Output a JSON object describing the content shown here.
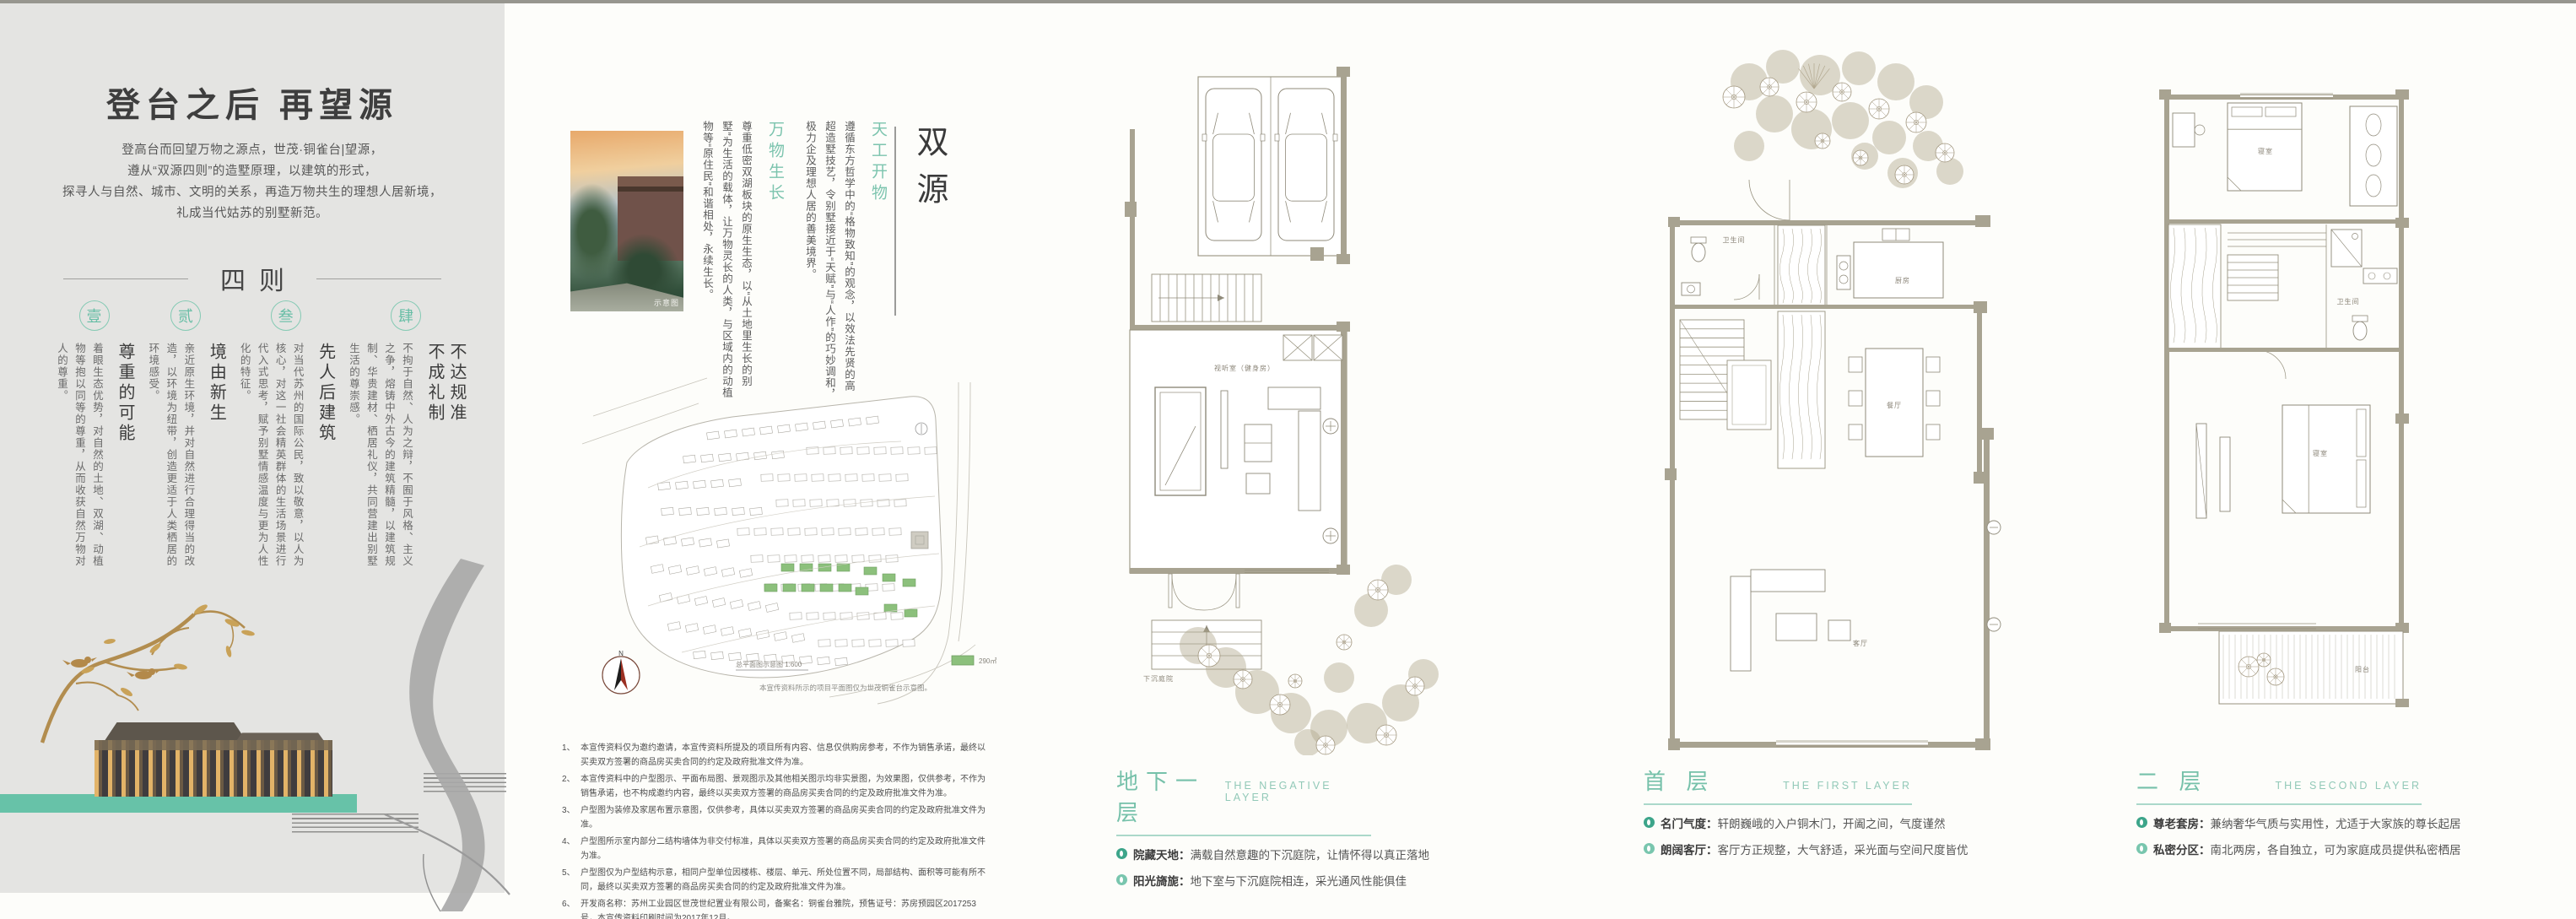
{
  "colors": {
    "accent_teal": "#74c3ab",
    "band_teal": "#67c2a8",
    "site_green": "#8cc07c",
    "wall_tan": "#a9a492",
    "panel_gray": "#e4e4e2"
  },
  "left_panel": {
    "title": "登台之后 再望源",
    "intro_lines": [
      "登高台而回望万物之源点，世茂·铜雀台|望源，",
      "遵从“双源四则”的造墅原理，以建筑的形式，",
      "探寻人与自然、城市、文明的关系，再造万物共生的理想人居新境，",
      "礼成当代姑苏的别墅新范。"
    ],
    "section_title": "四则",
    "principles": [
      {
        "num": "壹",
        "title": "尊重的可能",
        "body": "着眼生态优势，对自然的土地、双湖、动植物等抱以同等的尊重，从而收获自然万物对人的尊重。"
      },
      {
        "num": "贰",
        "title": "境由新生",
        "body": "亲近原生环境，并对自然进行合理得当的改造，以环境为纽带，创造更适于人类栖居的环境感受。"
      },
      {
        "num": "叁",
        "title": "先人后建筑",
        "body": "对当代苏州的国际公民，致以敬意，以人为核心，对这一社会精英群体的生活场景进行代入式思考，赋予别墅情感温度与更为人性化的特征。"
      },
      {
        "num": "肆",
        "title": "不达规准\n不成礼制",
        "body": "不拘于自然、人为之辩，不囿于风格、主义之争，熔铸中外古今的建筑精髓，以建筑规制、华贵建材、栖居礼仪，共同营建出别墅生活的尊崇感。"
      }
    ]
  },
  "concept": {
    "headline": "双源",
    "photo_label": "示意图",
    "principles": [
      {
        "title": "天工开物",
        "body": "遵循东方哲学中的“格物致知”的观念，以效法先贤的高超造墅技艺，令别墅接近于“天赋”与“人作”的巧妙调和，极力企及理想人居的善美境界。"
      },
      {
        "title": "万物生长",
        "body": "尊重低密双湖板块的原生生态，以“从土地里生长的别墅”为生活的载体，让万物灵长的人类，与区域内的动植物等“原住民”和谐相处，永续生长。"
      }
    ],
    "siteplan": {
      "compass": "N",
      "scale_label": "总平面图示意图 1:600",
      "legend_label": "290㎡",
      "note": "本宣传资料所示的项目平面图仅为世茂铜雀台示意图。"
    },
    "disclaimers": [
      {
        "num": "1、",
        "text": "本宣传资料仅为邀约邀请，本宣传资料所提及的项目所有内容、信息仅供购房参考，不作为销售承诺，最终以买卖双方签署的商品房买卖合同的约定及政府批准文件为准。"
      },
      {
        "num": "2、",
        "text": "本宣传资料中的户型图示、平面布局图、景观图示及其他相关图示均非实景图，为效果图，仅供参考，不作为销售承诺，也不构成邀约内容，最终以买卖双方签署的商品房买卖合同的约定及政府批准文件为准。"
      },
      {
        "num": "3、",
        "text": "户型图为装修及家居布置示意图，仅供参考，具体以买卖双方签署的商品房买卖合同的约定及政府批准文件为准。"
      },
      {
        "num": "4、",
        "text": "户型图所示室内部分二结构墙体为非交付标准，具体以买卖双方签署的商品房买卖合同的约定及政府批准文件为准。"
      },
      {
        "num": "5、",
        "text": "户型图仅为户型结构示意，相同户型单位因楼栋、楼层、单元、所处位置不同，局部结构、面积等可能有所不同，最终以买卖双方签署的商品房买卖合同的约定及政府批准文件为准。"
      },
      {
        "num": "6、",
        "text": "开发商名称：苏州工业园区世茂世纪置业有限公司，备案名：铜雀台雅院，预售证号：苏房预园区2017253号，本宣传资料印刷时间为2017年12月。"
      }
    ]
  },
  "floors": [
    {
      "name": "地下一层",
      "name_en": "THE NEGATIVE LAYER",
      "features": [
        {
          "label": "院藏天地：",
          "text": "满载自然意趣的下沉庭院，让情怀得以真正落地"
        },
        {
          "label": "阳光旖旎：",
          "text": "地下室与下沉庭院相连，采光通风性能俱佳"
        }
      ],
      "labels": {
        "room": "视听室（健身房）",
        "courtyard": "下沉庭院"
      }
    },
    {
      "name": "首 层",
      "name_en": "THE FIRST LAYER",
      "features": [
        {
          "label": "名门气度：",
          "text": "轩朗巍峨的入户铜木门，开阖之间，气度谨然"
        },
        {
          "label": "朗阔客厅：",
          "text": "客厅方正规整，大气舒适，采光面与空间尺度皆优"
        }
      ],
      "labels": {
        "bath": "卫生间",
        "kitchen": "厨房",
        "dining": "餐厅",
        "living": "客厅"
      }
    },
    {
      "name": "二 层",
      "name_en": "THE SECOND LAYER",
      "features": [
        {
          "label": "尊老套房：",
          "text": "兼纳奢华气质与实用性，尤适于大家族的尊长起居"
        },
        {
          "label": "私密分区：",
          "text": "南北两房，各自独立，可为家庭成员提供私密栖居"
        }
      ],
      "labels": {
        "bed1": "寝室",
        "bath": "卫生间",
        "bed2": "寝室",
        "balcony": "阳台"
      }
    }
  ]
}
